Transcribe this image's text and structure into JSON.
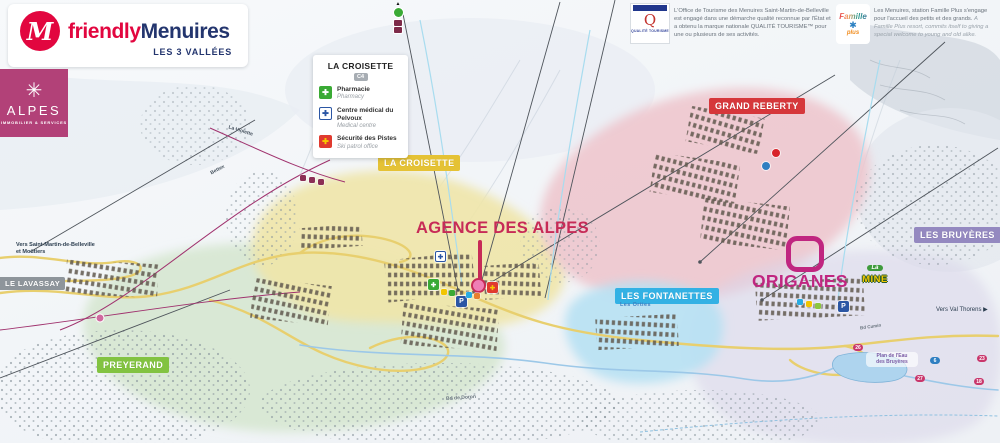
{
  "branding": {
    "logo_m": "M",
    "friendly": "friendly",
    "menuires": "Menuires",
    "tagline": "LES 3 VALLÉES",
    "alpes": {
      "name": "ALPES",
      "subtitle": "IMMOBILIER & SERVICES"
    }
  },
  "notices": {
    "qualite_logo": {
      "q": "Q",
      "caption": "QUALITÉ TOURISME"
    },
    "fr": "L'Office de Tourisme des Menuires Saint-Martin-de-Belleville est engagé dans une démarche qualité reconnue par l'État et a obtenu la marque nationale QUALITÉ TOURISME™ pour une ou plusieurs de ses activités.",
    "famille_logo": {
      "name": "Famille",
      "plus": "plus"
    },
    "en_main": "Les Menuires, station Famille Plus s'engage pour l'accueil des petits et des grands. ",
    "en_sub": "A Famille Plus resort, commits itself to giving a special welcome to young and old alike."
  },
  "legend": {
    "title": "LA CROISETTE",
    "grid_ref": "C4",
    "items": [
      {
        "label_fr": "Pharmacie",
        "label_en": "Pharmacy"
      },
      {
        "label_fr": "Centre médical du Pelvoux",
        "label_en": "Medical centre"
      },
      {
        "label_fr": "Sécurité des Pistes",
        "label_en": "Ski patrol office"
      }
    ]
  },
  "districts": {
    "la_croisette": "LA CROISETTE",
    "grand_reberty": "GRAND REBERTY",
    "les_bruyeres": "LES BRUYÈRES",
    "les_fontanettes": "LES FONTANETTES",
    "preyerand": "PREYERAND",
    "le_lavassay": "LE LAVASSAY"
  },
  "highlights": {
    "agence": "AGENCE DES ALPES",
    "origanes": "ORIGANES"
  },
  "map_labels": {
    "vers_smb_1": "Vers Saint-Martin-de-Belleville",
    "vers_smb_2": "et Moûtiers",
    "vers_val_thorens": "Vers Val Thorens",
    "la_violette": "La Violette",
    "bettex": "Bettex",
    "bd_de_doron": "Bd de Doron",
    "bd_cumin": "Bd Cumin",
    "les_orties": "Les Orties",
    "plan_eau_1": "Plan de l'Eau",
    "plan_eau_2": "des Bruyères",
    "la_mine_la": "La",
    "la_mine_mine": "MINE",
    "parking": "P"
  },
  "route_markers": [
    {
      "label": "26"
    },
    {
      "label": "27"
    },
    {
      "label": "18"
    },
    {
      "label": "23"
    },
    {
      "label": "6"
    }
  ],
  "icons": {
    "cross": "✚",
    "alpes_star": "✳",
    "famille_star": "✱",
    "arrow_right": "▶",
    "arrow_up": "▲"
  },
  "colors": {
    "brand_red": "#e2063f",
    "brand_navy": "#23356e",
    "alpes_pink": "#b24178",
    "croisette_yellow": "#e5c235",
    "reberty_red": "#d6373b",
    "bruyeres_purple": "#9489c0",
    "fontanettes_cyan": "#33b1e4",
    "preyerand_green": "#82c341",
    "lavassay_gray": "#8e959b",
    "agence_accent": "#c72b57",
    "origanes_accent": "#c02680"
  }
}
